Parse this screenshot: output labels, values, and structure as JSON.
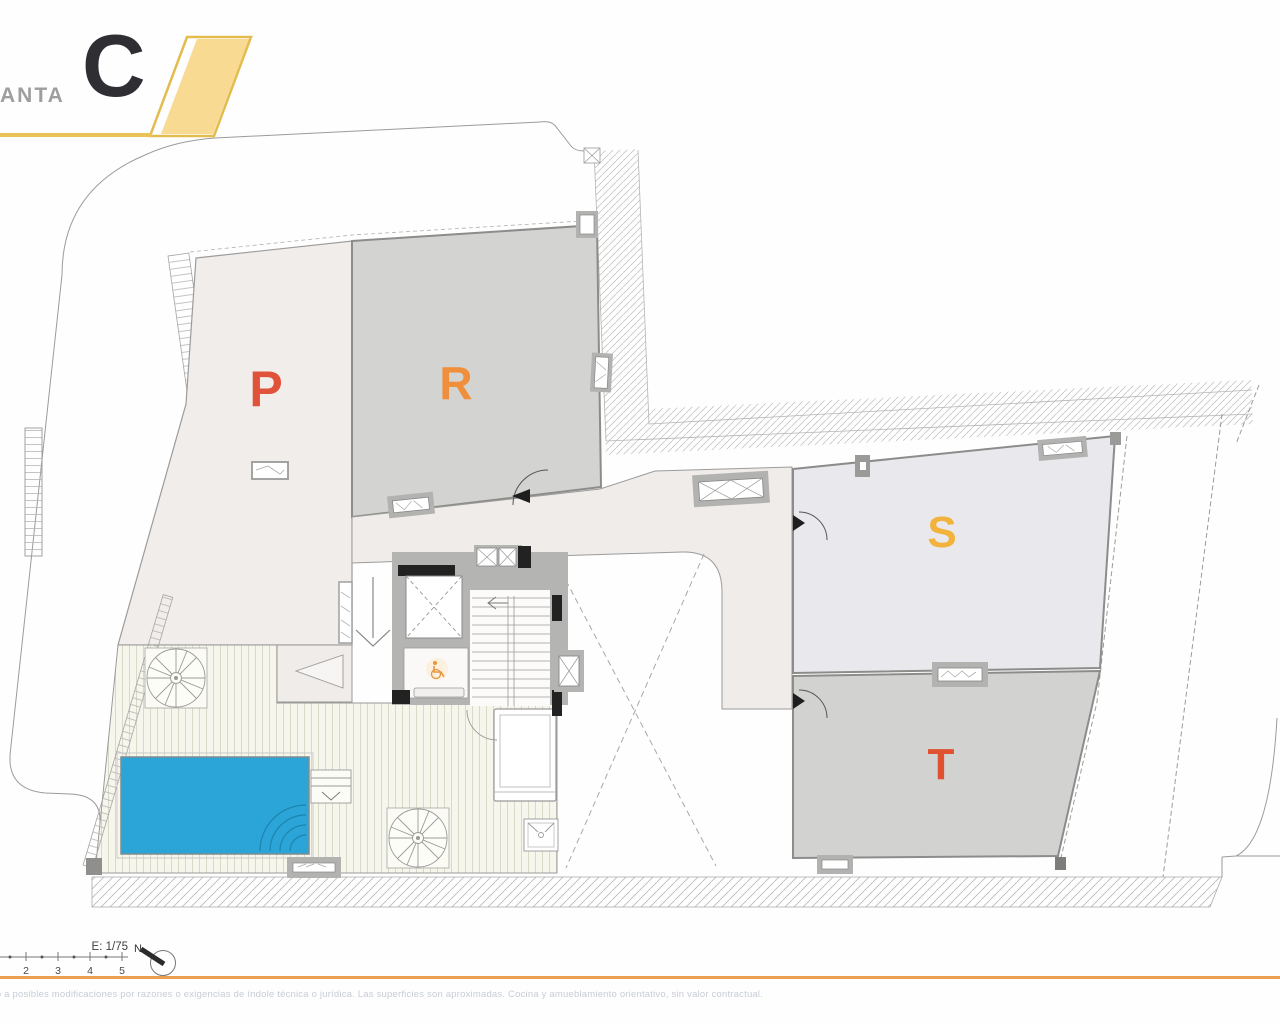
{
  "header": {
    "series_label": "ANTA",
    "plan_letter": "C"
  },
  "plan": {
    "rooms": [
      {
        "id": "p",
        "label": "P",
        "color": "#e0523a"
      },
      {
        "id": "r",
        "label": "R",
        "color": "#ef8f3c"
      },
      {
        "id": "s",
        "label": "S",
        "color": "#f2b33d"
      },
      {
        "id": "t",
        "label": "T",
        "color": "#e0512f"
      }
    ]
  },
  "footer": {
    "scale_label": "E: 1/75",
    "ticks": [
      "2",
      "3",
      "4",
      "5"
    ],
    "north_label": "N",
    "disclaimer": "to a posibles modificaciones por razones o exigencias de índole técnica o jurídica. Las superficies son aproximadas. Cocina y amueblamiento orientativo, sin valor contractual."
  },
  "colors": {
    "accent_yellow": "#e9c258",
    "accent_orange": "#ec9f4e",
    "pool_blue": "#2ba4d7"
  }
}
